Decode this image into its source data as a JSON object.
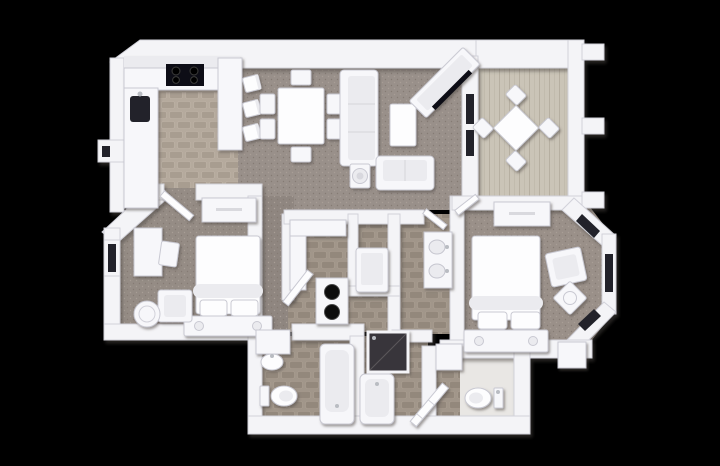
{
  "scene": {
    "description": "Top-down 3D architectural render of a two-bedroom, two-bathroom apartment floor plan with balcony, shown in white on a black background",
    "view": "top-down 3D render",
    "background": "#000000"
  },
  "colors": {
    "bg": "#000000",
    "wall": "#f4f4f7",
    "wall_edge": "#d2d2da",
    "furn": "#f7f7fa",
    "furn_edge": "#c9c9d2",
    "furn_inner": "#ebebef",
    "white_soft": "#fdfdfe",
    "carpet_main": "#99908a",
    "carpet_hall": "#8f8680",
    "carpet_bd2": "#958c85",
    "carpet_master": "#9a9089",
    "carpet_dark": "#857b74",
    "carpet_light": "#a89e96",
    "tile_k_base": "#b5aa9d",
    "tile_k": "#a89d90",
    "tile_k_hi": "#c0b5a8",
    "tile_b_base": "#a1968a",
    "tile_b": "#93887c",
    "tile_b_hi": "#ab9f92",
    "wood_base": "#cac4b7",
    "wood_line": "#b6afa1",
    "wc_floor": "#e9e7e4",
    "glass": "#20242a",
    "black": "#101012",
    "burner": "#060606",
    "steel": "#b9bcc2",
    "shower_dark": "#39363a"
  },
  "rooms": [
    {
      "id": "kitchen",
      "label": "kitchen",
      "floor": "tile",
      "furniture": [
        "l-shaped-counter",
        "upper-cabinets",
        "cooktop",
        "kitchen-sink",
        "breakfast-bar"
      ],
      "counts": {
        "burners": 4,
        "bar_stools": 3
      }
    },
    {
      "id": "dining",
      "label": "dining-area",
      "floor": "carpet",
      "furniture": [
        "dining-table"
      ],
      "counts": {
        "dining_chairs": 6
      }
    },
    {
      "id": "living",
      "label": "living-room",
      "floor": "carpet",
      "furniture": [
        "sofa",
        "loveseat",
        "coffee-table",
        "side-table",
        "tv-console",
        "tv"
      ]
    },
    {
      "id": "balcony",
      "label": "balcony",
      "floor": "wood-plank",
      "furniture": [
        "bistro-table"
      ],
      "counts": {
        "patio_chairs": 4,
        "railing_posts": 3
      }
    },
    {
      "id": "bedroom-2",
      "label": "bedroom-2",
      "floor": "carpet",
      "furniture": [
        "bed",
        "storage-bench",
        "dresser",
        "desk",
        "desk-chair",
        "armchair",
        "round-side-table",
        "window",
        "door"
      ]
    },
    {
      "id": "master-bedroom",
      "label": "master-bedroom",
      "floor": "carpet",
      "furniture": [
        "bed",
        "storage-bench",
        "nightstand-left",
        "nightstand-right",
        "dresser",
        "armchair",
        "corner-side-table"
      ],
      "counts": {
        "bay_windows": 3
      }
    },
    {
      "id": "master-bathroom",
      "label": "master-bathroom",
      "floor": "tile",
      "furniture": [
        "double-vanity",
        "double-doors"
      ],
      "counts": {
        "sinks": 2
      }
    },
    {
      "id": "laundry",
      "label": "laundry-utility",
      "floor": "tile",
      "furniture": [
        "stacked-washer-dryer",
        "counter",
        "water-heater"
      ]
    },
    {
      "id": "bathroom-2",
      "label": "bathroom-2",
      "floor": "tile",
      "furniture": [
        "pedestal-sink",
        "toilet",
        "bathtub",
        "linen-shelf"
      ]
    },
    {
      "id": "master-tub-room",
      "label": "master-tub-and-shower",
      "floor": "tile",
      "furniture": [
        "bathtub",
        "shower",
        "open-door"
      ]
    },
    {
      "id": "water-closet",
      "label": "water-closet",
      "floor": "tile-and-white",
      "furniture": [
        "toilet"
      ]
    },
    {
      "id": "hallway",
      "label": "hallway",
      "floor": "carpet",
      "furniture": [
        "door-leafs"
      ]
    }
  ]
}
